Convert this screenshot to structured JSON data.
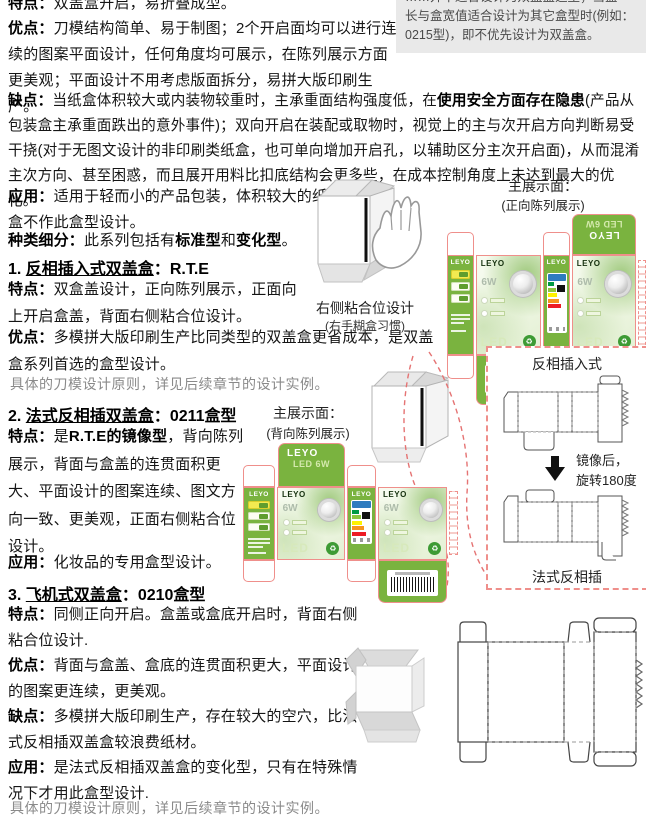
{
  "intro": {
    "p_tedian": {
      "label": "特点：",
      "text": "双盖盒开启，易折叠成型。"
    },
    "p_youdian": {
      "label": "优点：",
      "text": "刀模结构简单、易于制图；2个开启面均可以进行连续的图案平面设计，任何角度均可展示，在陈列展示方面更美观；平面设计不用考虑版面拆分，易拼大版印刷生产。"
    },
    "p_quedian": {
      "label": "缺点：",
      "seg1": "当纸盒体积较大或内装物较重时，主承重面结构强度低，在",
      "bold1": "使用安全方面存在隐患",
      "seg2": "(产品从包装盒主承重面跌出的意外事件)；双向开启在装配或取物时，视觉上的主与次开启方向判断易受干挠(对于无图文设计的非印刷类纸盒，也可单向增加开启孔，以辅助区分主次开启面)，从而混淆主次方向、甚至困惑，而且展开用料比扣底结构会更多些，在成本控制角度上未达到最大的优化。"
    },
    "p_yingyong": {
      "label": "应用：",
      "text": "适用于轻而小的产品包装，体积较大的纸盒不作此盒型设计。"
    },
    "p_zhonglei": {
      "label": "种类细分：",
      "seg1": "此系列包括有",
      "bold1": "标准型",
      "seg2": "和",
      "bold2": "变化型",
      "seg3": "。"
    }
  },
  "note_box": {
    "line1": "……并不适合设计为双盖盒造型；当盒",
    "line2": "长与盒宽值适合设计为其它盒型时(例如：",
    "line3": "0215型)，即不优先设计为双盖盒。"
  },
  "section1": {
    "num": "1. ",
    "title": "反相插入式双盖盒",
    "sep": "：",
    "code": "R.T.E",
    "p_tedian": {
      "label": "特点：",
      "text": "双盒盖设计，正向陈列展示，正面向上开启盒盖，背面右侧粘合位设计。"
    },
    "p_youdian": {
      "label": "优点：",
      "text": "多模拼大版印刷生产比同类型的双盖盒更省成本，是双盖盒系列首选的盒型设计。"
    },
    "note": "具体的刀模设计原则，详见后续章节的设计实例。"
  },
  "section2": {
    "num": "2. ",
    "title": "法式反相插双盖盒",
    "sep": "：",
    "code": "0211盒型",
    "p_tedian": {
      "label": "特点：",
      "seg1": "是",
      "bold1": "R.T.E的镜像型",
      "seg2": "，背向陈列展示，背面与盒盖的连贯面积更大、平面设计的图案连续、图文方向一致、更美观，正面右侧粘合位设计。"
    },
    "p_yingyong": {
      "label": "应用：",
      "text": "化妆品的专用盒型设计。"
    }
  },
  "section3": {
    "num": "3. ",
    "title": "飞机式双盖盒",
    "sep": "：",
    "code": "0210盒型",
    "p_tedian": {
      "label": "特点：",
      "text": "同侧正向开启。盒盖或盒底开启时，背面右侧粘合位设计."
    },
    "p_youdian": {
      "label": "优点：",
      "text": "背面与盒盖、盒底的连贯面积更大，平面设计的图案更连续，更美观。"
    },
    "p_quedian": {
      "label": "缺点：",
      "text": "多模拼大版印刷生产，存在较大的空穴，比法式反相插双盖盒较浪费纸材。"
    },
    "p_yingyong": {
      "label": "应用：",
      "text": "是法式反相插双盖盒的变化型，只有在特殊情况下才用此盒型设计."
    },
    "note": "具体的刀模设计原则，详见后续章节的设计实例。"
  },
  "figures": {
    "glue_caption": "右侧粘合位设计",
    "glue_caption_sub": "(右手糊盒习惯)",
    "display1_title": "主展示面：",
    "display1_sub": "(正向陈列展示)",
    "display2_title": "主展示面：",
    "display2_sub": "(背向陈列展示)",
    "mirror_panel": {
      "top_label": "反相插入式",
      "arrow_note1": "镜像后，",
      "arrow_note2": "旋转180度",
      "bottom_label": "法式反相插"
    },
    "leyo": {
      "brand": "LEYO",
      "power": "6W",
      "led": "LED",
      "model": "LED 6W",
      "eco_icon": "♻"
    }
  },
  "colors": {
    "box_green": "#7ab33f",
    "dieline_pink": "#ef8f8b",
    "note_bg": "#e9e9e9"
  }
}
